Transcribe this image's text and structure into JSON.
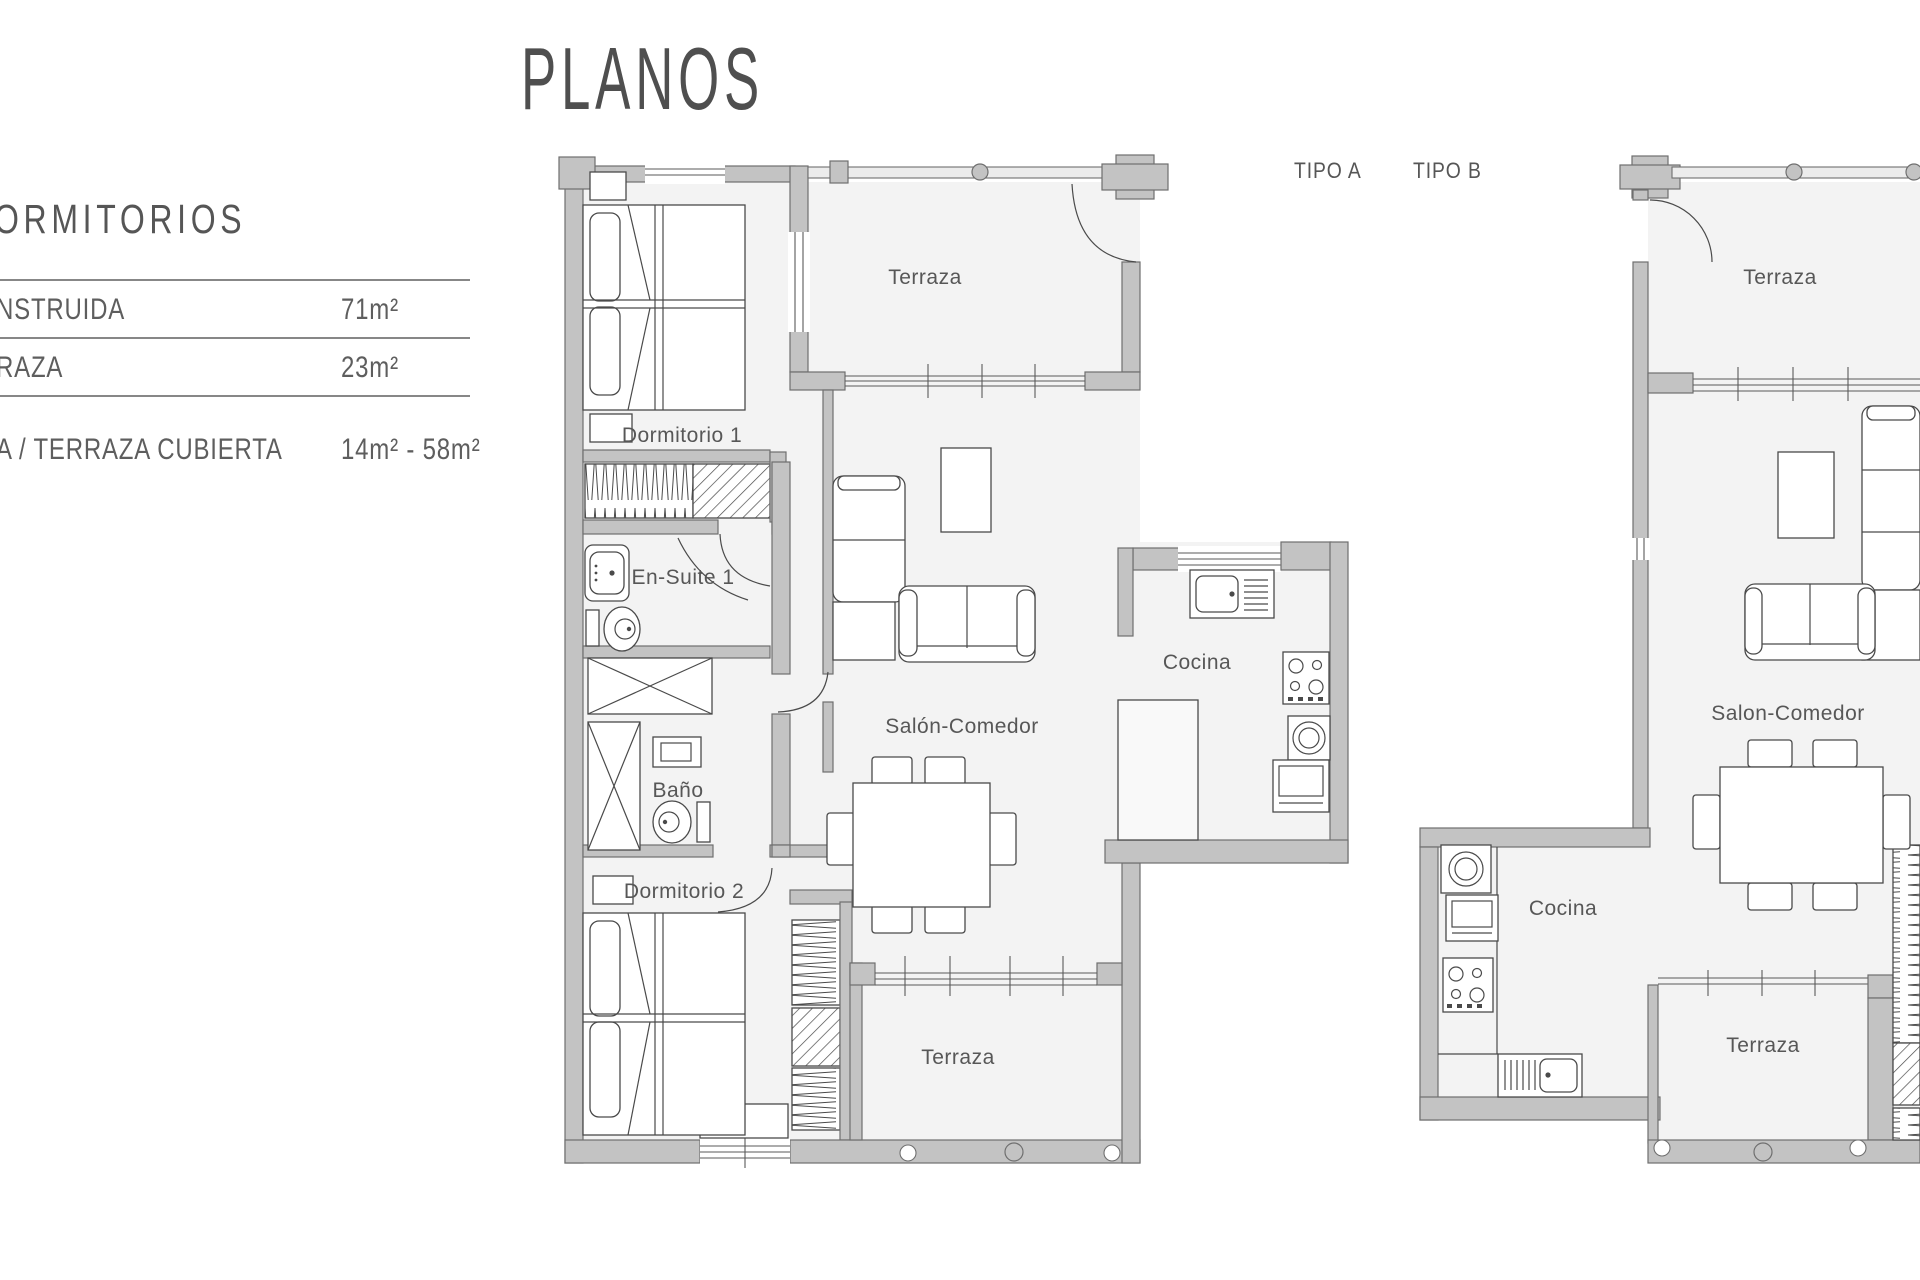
{
  "page": {
    "title": "PLANOS"
  },
  "info_panel": {
    "heading": "ORMITORIOS",
    "rows": [
      {
        "label": "NSTRUIDA",
        "value": "71m²"
      },
      {
        "label": "RAZA",
        "value": "23m²"
      },
      {
        "label": "A / TERRAZA CUBIERTA",
        "value": "14m² - 58m²"
      }
    ]
  },
  "plan_labels": {
    "tipo_a": "TIPO A",
    "tipo_b": "TIPO B"
  },
  "plan_a": {
    "rooms": {
      "terraza_top": "Terraza",
      "dormitorio1": "Dormitorio 1",
      "ensuite": "En-Suite 1",
      "salon": "Salón-Comedor",
      "cocina": "Cocina",
      "bano": "Baño",
      "dormitorio2": "Dormitorio 2",
      "terraza_bottom": "Terraza"
    }
  },
  "plan_b": {
    "rooms": {
      "terraza_top": "Terraza",
      "salon": "Salon-Comedor",
      "cocina": "Cocina",
      "terraza_bottom": "Terraza"
    }
  },
  "colors": {
    "wall": "#c3c3c3",
    "wall_outline": "#6f6f6f",
    "floor": "#f3f3f3",
    "text": "#575757",
    "line": "#4a4a4a"
  }
}
